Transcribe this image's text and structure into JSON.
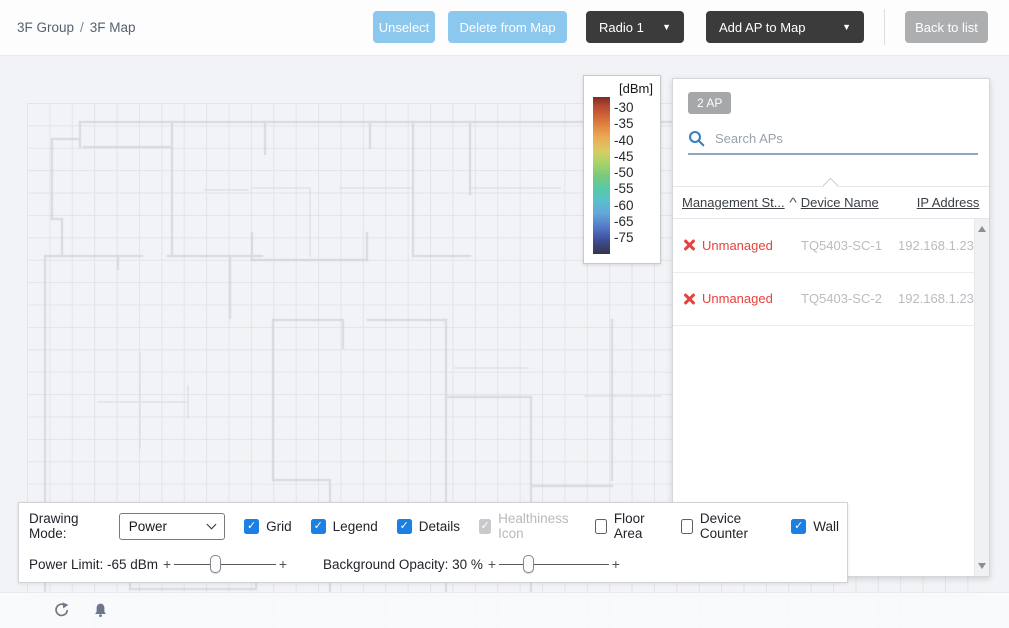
{
  "breadcrumb": {
    "group": "3F Group",
    "separator": "/",
    "map": "3F Map"
  },
  "toolbar": {
    "unselect_label": "Unselect",
    "delete_from_map_label": "Delete from Map",
    "radio_select_value": "Radio 1",
    "add_ap_label": "Add AP to Map",
    "back_to_list_label": "Back to list",
    "dropdown_arrow": "▼"
  },
  "legend": {
    "title": "[dBm]",
    "ticks": [
      "-30",
      "-35",
      "-40",
      "-45",
      "-50",
      "-55",
      "-60",
      "-65",
      "-75"
    ],
    "gradient_top_color": "#7D2A20",
    "gradient_bottom_color": "#35344A"
  },
  "ap_panel": {
    "count_badge": "2 AP",
    "search_placeholder": "Search APs",
    "columns": {
      "status": "Management St...",
      "sort_indicator": "^",
      "device": "Device Name",
      "ip": "IP Address"
    },
    "rows": [
      {
        "status": "Unmanaged",
        "device": "TQ5403-SC-1",
        "ip": "192.168.1.231"
      },
      {
        "status": "Unmanaged",
        "device": "TQ5403-SC-2",
        "ip": "192.168.1.232"
      }
    ]
  },
  "controls": {
    "drawing_mode_label": "Drawing Mode:",
    "drawing_mode_value": "Power",
    "checkboxes": [
      {
        "label": "Grid",
        "checked": true,
        "disabled": false
      },
      {
        "label": "Legend",
        "checked": true,
        "disabled": false
      },
      {
        "label": "Details",
        "checked": true,
        "disabled": false
      },
      {
        "label": "Healthiness Icon",
        "checked": true,
        "disabled": true
      },
      {
        "label": "Floor Area",
        "checked": false,
        "disabled": false
      },
      {
        "label": "Device Counter",
        "checked": false,
        "disabled": false
      },
      {
        "label": "Wall",
        "checked": true,
        "disabled": false
      }
    ],
    "power_limit_label": "Power Limit: -65 dBm",
    "power_limit_value_pct": 38,
    "background_opacity_label": "Background Opacity: 30 %",
    "background_opacity_value_pct": 26,
    "slider_end_tick": "+",
    "checkmark": "✓"
  },
  "colors": {
    "accent_blue_button": "#8CC7ED",
    "dark_button": "#3B3B3B",
    "gray_button": "#ADAEB0",
    "checkbox_blue": "#1B7FE4",
    "status_red": "#E8413D",
    "search_icon_blue": "#3D7FC0",
    "search_underline": "#90A8BD"
  },
  "icons": {
    "search": "magnifier",
    "sort": "caret-up",
    "row_status": "x-mark",
    "refresh": "circular-arrow",
    "notification": "bell"
  }
}
